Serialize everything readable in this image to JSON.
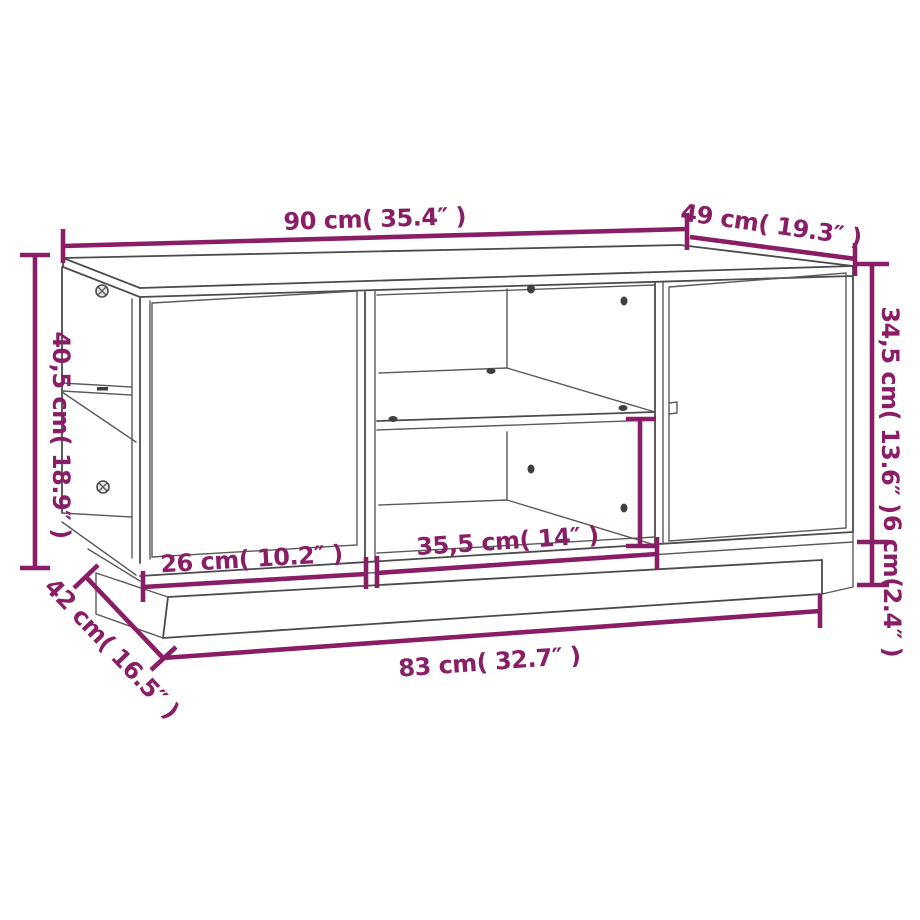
{
  "diagram": {
    "type": "furniture-dimension-diagram",
    "subject": "coffee table line drawing",
    "background_color": "#ffffff",
    "outline_color": "#4b4b4b",
    "dimension_color": "#8a1e66"
  },
  "dimensions": {
    "top_width": {
      "label": "90 cm( 35.4″ )"
    },
    "top_depth": {
      "label": "49 cm( 19.3″ )"
    },
    "height_left": {
      "label": "40,5 cm( 18.9″ )"
    },
    "height_right": {
      "label": "34,5 cm( 13.6″ )"
    },
    "plinth_height": {
      "label": "6 cm(2.4″ )"
    },
    "door_width": {
      "label": "26 cm( 10.2″ )"
    },
    "shelf_width": {
      "label": "35,5 cm( 14″ )"
    },
    "base_depth": {
      "label": "42 cm( 16.5″ )"
    },
    "base_width": {
      "label": "83 cm( 32.7″ )"
    }
  }
}
